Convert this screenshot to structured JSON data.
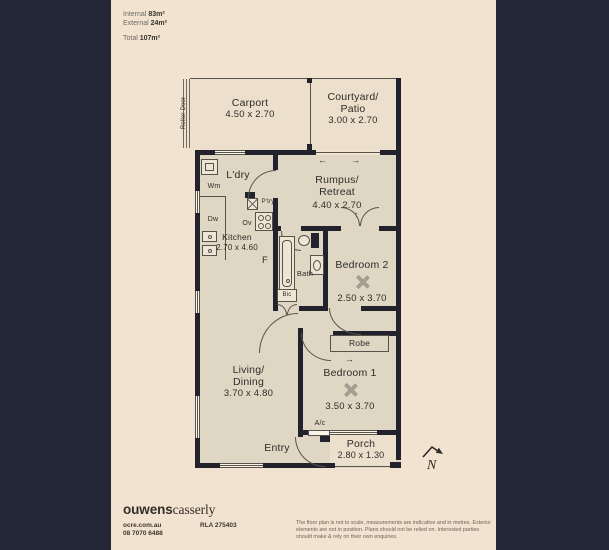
{
  "summary": {
    "rows": [
      {
        "label": "Internal",
        "value": "83m²"
      },
      {
        "label": "External",
        "value": "24m²"
      },
      {
        "label": "Total",
        "value": "107m²"
      }
    ]
  },
  "rooms": {
    "carport": {
      "name": "Carport",
      "dims": "4.50 x 2.70"
    },
    "courtyard": {
      "name": "Courtyard/",
      "name2": "Patio",
      "dims": "3.00 x 2.70"
    },
    "rumpus": {
      "name": "Rumpus/",
      "name2": "Retreat",
      "dims": "4.40 x 2.70"
    },
    "kitchen": {
      "name": "Kitchen",
      "dims": "2.70 x 4.60"
    },
    "laundry": {
      "name": "L'dry"
    },
    "bath": {
      "name": "Bath"
    },
    "bedroom2": {
      "name": "Bedroom 2",
      "dims": "2.50 x 3.70"
    },
    "robe": {
      "name": "Robe"
    },
    "bedroom1": {
      "name": "Bedroom 1",
      "dims": "3.50 x 3.70"
    },
    "living": {
      "name": "Living/",
      "name2": "Dining",
      "dims": "3.70 x 4.80"
    },
    "entry": {
      "name": "Entry"
    },
    "porch": {
      "name": "Porch",
      "dims": "2.80 x 1.30"
    }
  },
  "fixtures": {
    "roller_door": "Roller Door",
    "washing_machine": "Wm",
    "dishwasher": "Dw",
    "oven": "Ov",
    "pantry": "P'try",
    "fridge": "F",
    "built_in_cupboard": "Bic",
    "air_conditioner": "A/c"
  },
  "icons": {
    "arrow_left": "←",
    "arrow_right": "→",
    "arrow_up": "↑"
  },
  "compass": {
    "north": "N"
  },
  "footer": {
    "brand_bold": "ouwens",
    "brand_light": "casserly",
    "website": "ocre.com.au",
    "phone": "08 7070 6488",
    "rla": "RLA 275403",
    "disclaimer": "The floor plan is not to scale, measurements are indicative and in metres. Exterior elements are not in position. Plans should not be relied on. Interested parties should make & rely on their own enquiries."
  },
  "colors": {
    "background": "#242836",
    "panel": "#f2e3d0",
    "wall": "#21222c",
    "interior_floor": "#e0d6c4",
    "outdoor_floor": "#ecdfcc",
    "fan_mark": "#a59e90"
  }
}
